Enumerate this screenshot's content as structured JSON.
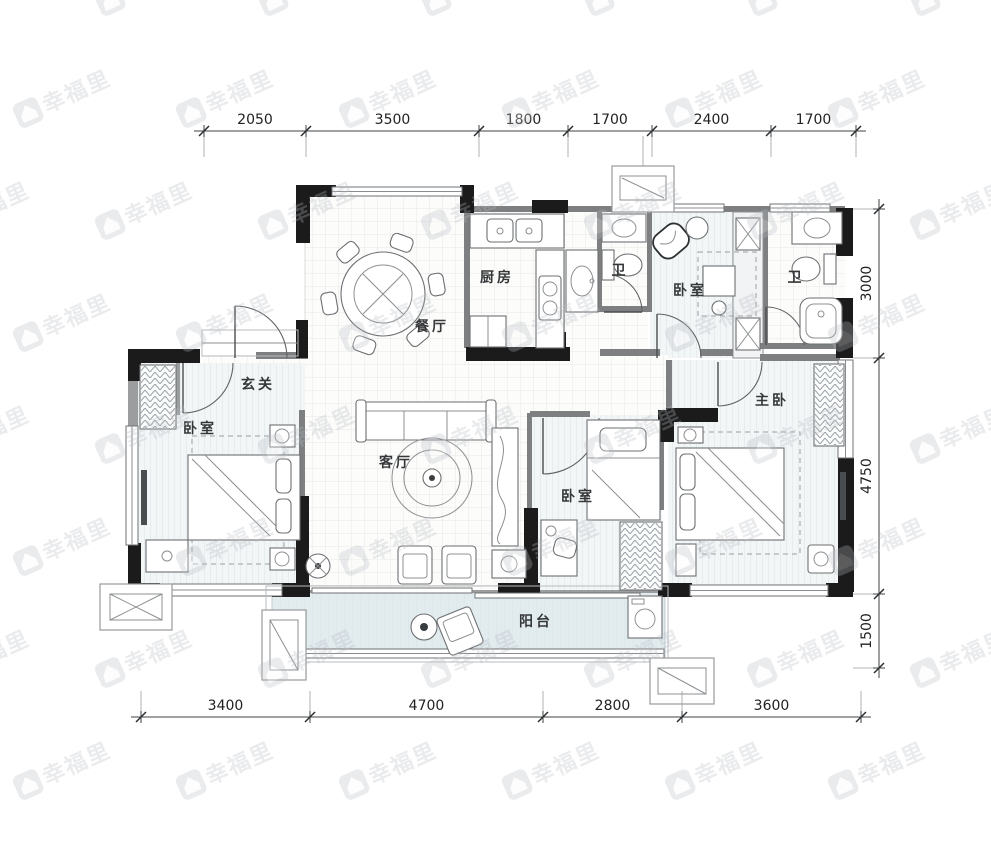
{
  "title": "residential floor plan",
  "watermark": {
    "text": "幸福里",
    "color": "#b9bcc3",
    "opacity": 0.3,
    "rotation": -24,
    "rows": 8,
    "cols": 8,
    "x_step": 163,
    "y_step": 112,
    "row_offset": 81,
    "x_start": -70,
    "y_start": -6
  },
  "floorplan": {
    "rooms": [
      {
        "id": "kitchen",
        "label": "厨房",
        "x": 497,
        "y": 282
      },
      {
        "id": "dining-room",
        "label": "餐厅",
        "x": 432,
        "y": 331
      },
      {
        "id": "bathroom-1",
        "label": "卫",
        "x": 620,
        "y": 275
      },
      {
        "id": "bedroom-north",
        "label": "卧室",
        "x": 690,
        "y": 295
      },
      {
        "id": "bathroom-2",
        "label": "卫",
        "x": 796,
        "y": 282
      },
      {
        "id": "foyer",
        "label": "玄关",
        "x": 258,
        "y": 389
      },
      {
        "id": "bedroom-west",
        "label": "卧室",
        "x": 200,
        "y": 433
      },
      {
        "id": "living-room",
        "label": "客厅",
        "x": 396,
        "y": 467
      },
      {
        "id": "master-bedroom",
        "label": "主卧",
        "x": 772,
        "y": 405
      },
      {
        "id": "bedroom-middle",
        "label": "卧室",
        "x": 578,
        "y": 501
      },
      {
        "id": "balcony",
        "label": "阳台",
        "x": 536,
        "y": 626
      }
    ]
  },
  "dimensions": {
    "top": {
      "line_y": 131,
      "label_values": [
        "2050",
        "3500",
        "1800",
        "1700",
        "2400",
        "1700"
      ],
      "ticks_px": [
        204,
        306,
        479,
        568,
        652,
        771,
        856
      ]
    },
    "bottom": {
      "line_y": 717,
      "label_values": [
        "3400",
        "4700",
        "2800",
        "3600"
      ],
      "ticks_px": [
        141,
        310,
        543,
        682,
        861
      ]
    },
    "right": {
      "line_x": 879,
      "label_values": [
        "3000",
        "4750",
        "1500"
      ],
      "ticks_px": [
        209,
        358,
        594,
        668
      ]
    }
  },
  "colors": {
    "wall": "#1b1b1b",
    "partition": "#7d7f80",
    "floor_tile": "#fcfcfb",
    "tile_grid": "#e7e7e4",
    "floor_plank": "#f2f6f7",
    "plank_stripe": "#dce4e7",
    "balcony_fill": "#e2ecef",
    "dim_text": "#222222",
    "label_text": "#353739",
    "watermark": "#b9bcc3"
  }
}
